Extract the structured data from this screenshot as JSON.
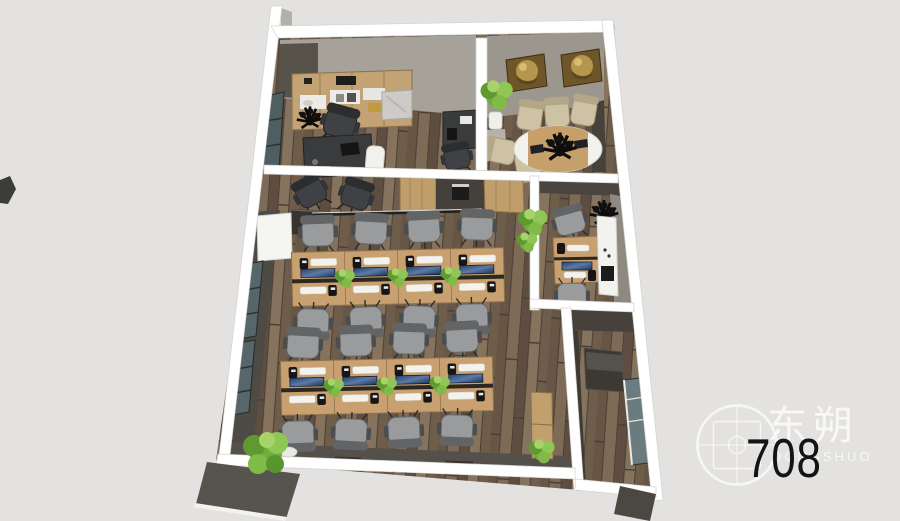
{
  "unit_label": "708",
  "watermark": {
    "brand_cn": "东朔",
    "brand_en": "DONGSHUO",
    "logo_icon": "crosshair-target-logo"
  },
  "scene": {
    "type": "3d_floor_plan_top_view",
    "unit": "708",
    "areas": [
      "executive-office",
      "conference-room",
      "corridor-waiting",
      "open-office",
      "private-office",
      "utility-room"
    ]
  },
  "palette": {
    "background": "#e3e2e0",
    "wall_white": "#ffffff",
    "wall_face_dark": "#55514a",
    "wall_face_light": "#a6a29a",
    "floor_wood": "#74624f",
    "desk_wood": "#c9a170",
    "screen_blue": "#3f5f8e",
    "plant_green": "#6fae3c",
    "chair_gray": "#9a9b9d",
    "chair_tan": "#cec2a4",
    "gold_art": "#8a6d35"
  }
}
